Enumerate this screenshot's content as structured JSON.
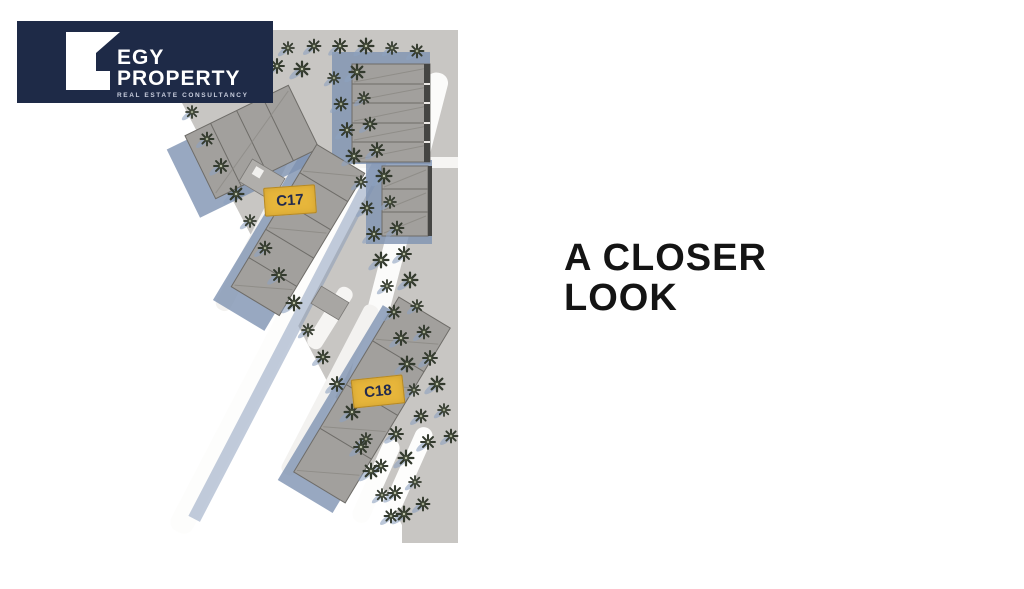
{
  "logo": {
    "line1": "EGY",
    "line2": "PROPERTY",
    "tagline": "REAL ESTATE CONSULTANCY"
  },
  "headline": {
    "line1": "A CLOSER",
    "line2": "LOOK"
  },
  "units": [
    {
      "label": "C17"
    },
    {
      "label": "C18"
    }
  ],
  "colors": {
    "brand_navy": "#1e2a47",
    "unit_marker_yellow": "#e7b63b",
    "ground_gray": "#c8c6c3",
    "building_gray": "#a2a09d",
    "shadow_blue": "#8096b6",
    "headline_black": "#141414"
  }
}
